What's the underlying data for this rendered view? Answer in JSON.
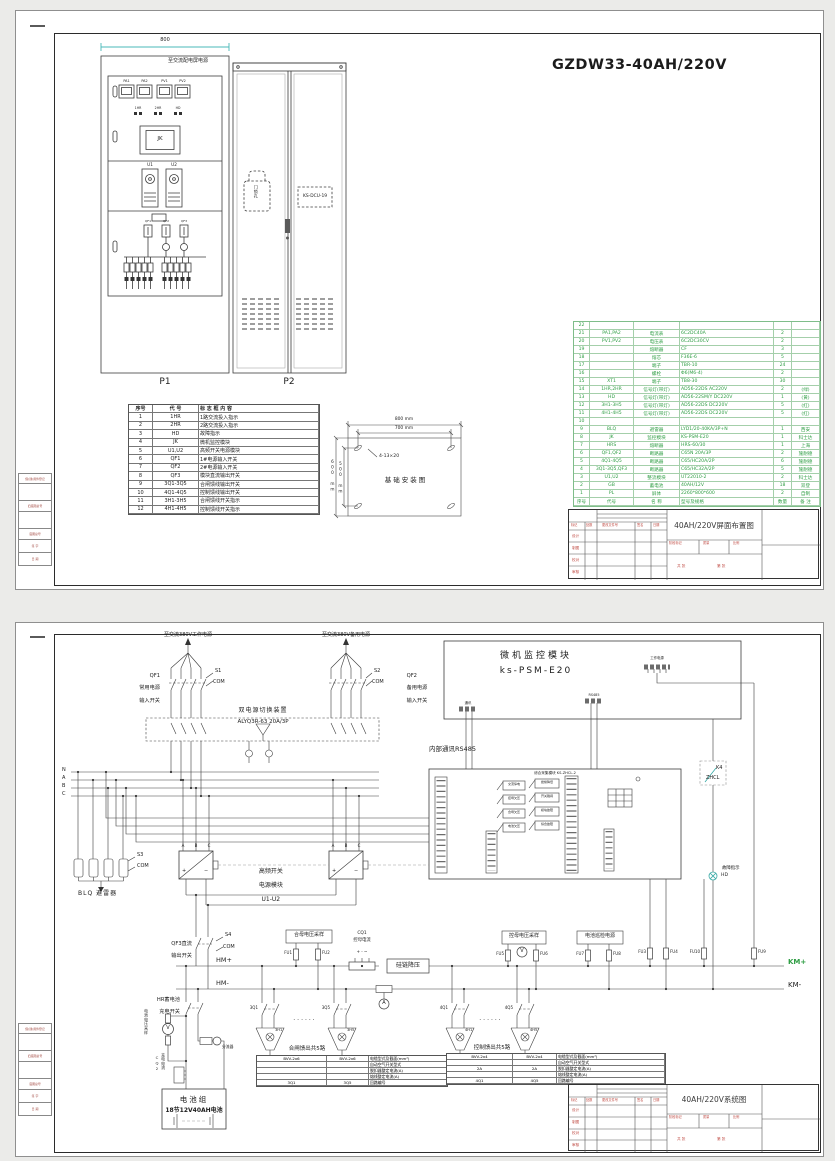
{
  "s1": {
    "title": "GZDW33-40AH/220V",
    "p1": {
      "label": "P1",
      "dim": "800",
      "top": "至交流配电屏电源",
      "meters": [
        "PA1",
        "PA2",
        "PV1",
        "PV2"
      ],
      "ind": [
        "1HR",
        "2HR",
        "HD"
      ],
      "jk": "JK",
      "u1": "U1",
      "u2": "U2",
      "qf1": "QF1",
      "qf2": "QF2",
      "qf3": "QF3"
    },
    "p2": {
      "label": "P2",
      "lock": "门锁孔",
      "dcu": "KS-DCU-19"
    },
    "lg": {
      "h": [
        "序号",
        "代 号",
        "标 志 框 内 容"
      ],
      "rows": [
        [
          "1",
          "1HR",
          "1路交流投入指示"
        ],
        [
          "2",
          "2HR",
          "2路交流投入指示"
        ],
        [
          "3",
          "HD",
          "故障指示"
        ],
        [
          "4",
          "JK",
          "微机监控模块"
        ],
        [
          "5",
          "U1,U2",
          "高频开关电源模块"
        ],
        [
          "6",
          "QF1",
          "1#电源输入开关"
        ],
        [
          "7",
          "QF2",
          "2#电源输入开关"
        ],
        [
          "8",
          "QF3",
          "模块直流输出开关"
        ],
        [
          "9",
          "3Q1-3Q5",
          "合闸馈线输出开关"
        ],
        [
          "10",
          "4Q1-4Q5",
          "控制馈线输出开关"
        ],
        [
          "11",
          "3H1-3H5",
          "合闸馈线开关指示"
        ],
        [
          "12",
          "4H1-4H5",
          "控制馈线开关指示"
        ]
      ]
    },
    "fd": {
      "t": "基础安装图",
      "d1": "800 mm",
      "d2": "700 mm",
      "d3": "600 mm",
      "d4": "500 mm",
      "slots": "4-13×20"
    },
    "bom": {
      "h": [
        "序号",
        "代号",
        "名 称",
        "型号及规格",
        "数量",
        "备 注"
      ],
      "rows": [
        [
          "22",
          "",
          "",
          "",
          "",
          ""
        ],
        [
          "21",
          "PA1,PA2",
          "电流表",
          "6C2DC40A",
          "2",
          ""
        ],
        [
          "20",
          "PV1,PV2",
          "电压表",
          "6C2DC30CV",
          "2",
          ""
        ],
        [
          "19",
          "",
          "熔断器",
          "CF",
          "3",
          ""
        ],
        [
          "18",
          "",
          "熔芯",
          "F36E-6",
          "5",
          ""
        ],
        [
          "17",
          "",
          "端子",
          "TBR-10",
          "24",
          ""
        ],
        [
          "16",
          "",
          "螺栓",
          "Φ6(M6-4)",
          "2",
          ""
        ],
        [
          "15",
          "XT1",
          "端子",
          "TB8-30",
          "30",
          ""
        ],
        [
          "14",
          "1HR,2HR",
          "信号灯(带灯)",
          "AD56-22DS AC220V",
          "2",
          "(绿)"
        ],
        [
          "13",
          "HD",
          "信号灯(带灯)",
          "AD56-22SM/Y DC220V",
          "1",
          "(黄)"
        ],
        [
          "12",
          "3H1-3H5",
          "信号灯(带灯)",
          "AD56-22DS DC220V",
          "5",
          "(红)"
        ],
        [
          "11",
          "4H1-4H5",
          "信号灯(带灯)",
          "AD56-22DS DC220V",
          "5",
          "(红)"
        ],
        [
          "10",
          "",
          "",
          "",
          "",
          ""
        ],
        [
          "9",
          "BLQ",
          "避雷器",
          "LYD1/20-40KA/3P+N",
          "1",
          "西安"
        ],
        [
          "8",
          "JK",
          "监控模块",
          "KS-PSM-E20",
          "1",
          "科士达"
        ],
        [
          "7",
          "HRS",
          "熔断器",
          "HRS-60/30",
          "1",
          "上海"
        ],
        [
          "6",
          "QF1,QF2",
          "断路器",
          "C65N 20A/3P",
          "2",
          "施耐德"
        ],
        [
          "5",
          "4Q1-4Q5",
          "断路器",
          "C65/HC20A/2P",
          "6",
          "施耐德"
        ],
        [
          "4",
          "3Q1-3Q5,QF3",
          "断路器",
          "C65/HC32A/2P",
          "5",
          "施耐德"
        ],
        [
          "3",
          "U1,U2",
          "整流模块",
          "UT22010-2",
          "2",
          "科士达"
        ],
        [
          "2",
          "GB",
          "蓄电池",
          "40AH/12V",
          "18",
          "双登"
        ],
        [
          "1",
          "PL",
          "屏体",
          "2260*800*600",
          "2",
          "自制"
        ]
      ]
    },
    "tbt": "40AH/220V屏面布置图"
  },
  "s2": {
    "sup1": "至交流380V工作电源",
    "sup2": "至交流380V备用电源",
    "qf1": [
      "QF1",
      "常用电源",
      "输入开关"
    ],
    "sw1": {
      "s": "S1",
      "com": "COM"
    },
    "qf2": [
      "QF2",
      "备用电源",
      "输入开关"
    ],
    "sw2": {
      "s": "S2",
      "com": "COM"
    },
    "ats1": "双电源切换装置",
    "ats2": "ALYQ3R-63 20A/3P",
    "ph": [
      "N",
      "A",
      "B",
      "C"
    ],
    "mon": {
      "t1": "微机监控模块",
      "t2": "ks-PSM-E20",
      "c1": "工作电源",
      "c2": "RS485",
      "c3": "通讯"
    },
    "rs": "内部通讯RS485",
    "col": {
      "t": "综合采集模块 KS-ZHCL-2",
      "rl": [
        "交流停电",
        "控母欠压",
        "合母欠压",
        "电池欠压"
      ],
      "rr": [
        "绝缘降低",
        "开关跳闸",
        "模块故障",
        "综合故障"
      ]
    },
    "k4": {
      "a": "K4",
      "b": "ZHCL"
    },
    "flt": {
      "t": "故障指示",
      "hd": "HD"
    },
    "blq": {
      "t": "BLQ 避雷器",
      "s": "S3",
      "com": "COM"
    },
    "mod": {
      "a": "A",
      "b": "B",
      "c": "C",
      "p": "+",
      "m": "−",
      "l1": "高频开关",
      "l2": "电源模块",
      "l3": "U1-U2"
    },
    "qf3": {
      "l1": "QF3直流",
      "l2": "输出开关",
      "s": "S4",
      "com": "COM"
    },
    "bus": {
      "hmp": "HM+",
      "hmm": "HM-",
      "kmp": "KM+",
      "kmm": "KM-"
    },
    "smp": {
      "hm": "合母电压采样",
      "km": "控母电压采样",
      "xj": "电池巡检电源",
      "gl": "硅链降压",
      "dc": "电池电压采样"
    },
    "cq1": {
      "a": "CQ1",
      "b": "控母电流",
      "p": "+ - ~"
    },
    "cq2": {
      "a": "CQ2",
      "b": "充电电流"
    },
    "fu": {
      "f1": "FU1",
      "f2": "FU2",
      "f3": "FU3",
      "f4": "FU4",
      "f5": "FU5",
      "f6": "FU6",
      "f7": "FU7",
      "f8": "FU8",
      "f9": "FU9",
      "f10": "FU10"
    },
    "mtr": {
      "v": "V",
      "a": "A"
    },
    "hr": {
      "l1": "HR蓄电池",
      "l2": "充电开关"
    },
    "sh": "分流器",
    "bat": {
      "l1": "电池组",
      "l2": "18节12V40AH电池"
    },
    "dots": "······",
    "fd1": {
      "t": "合闸馈出共5路",
      "q1": "3Q1",
      "q5": "3Q5",
      "h1": "3H1",
      "h5": "3H5",
      "rows": [
        [
          "BVV-2x6",
          "BVV-2x6",
          "电缆型式及截面(mm²)"
        ],
        [
          "",
          "",
          "自动空气开关型式"
        ],
        [
          "",
          "",
          "脱扣器整定电流(A)"
        ],
        [
          "",
          "",
          "熔线整定电流(A)"
        ],
        [
          "3Q1",
          "3Q5",
          "回路编号"
        ]
      ]
    },
    "fd2": {
      "t": "控制馈出共5路",
      "q1": "4Q1",
      "q5": "4Q5",
      "h1": "4H1",
      "h5": "4H5",
      "rows": [
        [
          "BVV-2x4",
          "BVV-2x4",
          "电缆型式及截面(mm²)"
        ],
        [
          "",
          "",
          "自动空气开关型式"
        ],
        [
          "2A",
          "2A",
          "脱扣器整定电流(A)"
        ],
        [
          "",
          "",
          "熔线整定电流(A)"
        ],
        [
          "4Q1",
          "4Q5",
          "回路编号"
        ]
      ]
    },
    "tbt": "40AH/220V系统图"
  },
  "tb": {
    "mark": "标记",
    "cnt": "处数",
    "file": "更改文件号",
    "sign": "签名",
    "date": "日期",
    "r1": "设计",
    "r2": "制图",
    "r3": "校对",
    "r4": "审核",
    "st": "阶段标记",
    "ms": "质量",
    "sc": "比例",
    "sh1": "共 张",
    "sh2": "第 张"
  },
  "mg": {
    "r1": "借(通)用件登记",
    "r2": "旧底图总号",
    "r3": "底图总号",
    "r4": "签 字",
    "r5": "日 期"
  }
}
